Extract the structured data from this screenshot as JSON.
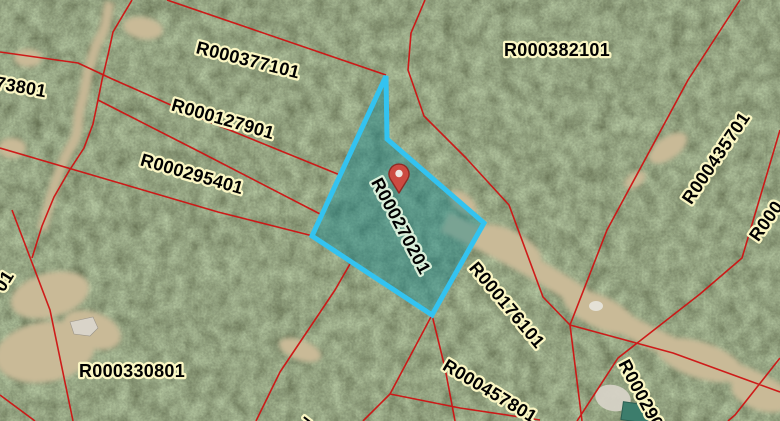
{
  "map": {
    "description": "Aerial parcel map with highlighted selected parcel and location marker",
    "colors": {
      "parcel_line": "#cf1212",
      "label_text": "#000000",
      "label_halo": "#fbf7c4",
      "selected_label_halo": "#d9efd9",
      "selected_outline": "#33c3f0",
      "selected_fill": "#0c8490"
    },
    "selected_parcel": {
      "id": "R000270201"
    },
    "marker": {
      "type": "location-pin",
      "fill": "#cc4a41",
      "outline": "#8e2a24",
      "hole": "#efe7e3"
    },
    "parcel_labels": [
      {
        "text": "73801",
        "partial": true
      },
      {
        "text": "R000377101",
        "partial": false
      },
      {
        "text": "R000127901",
        "partial": false
      },
      {
        "text": "R000295401",
        "partial": false
      },
      {
        "text": "R000382101",
        "partial": false
      },
      {
        "text": "R000435701",
        "partial": false
      },
      {
        "text": "R000176101",
        "partial": false
      },
      {
        "text": "R000330801",
        "partial": false
      },
      {
        "text": "R000457801",
        "partial": false
      },
      {
        "text": "R000290",
        "partial": true
      },
      {
        "text": "R000",
        "partial": true
      },
      {
        "text": "01",
        "partial": true
      },
      {
        "text": "7",
        "partial": true
      }
    ]
  }
}
